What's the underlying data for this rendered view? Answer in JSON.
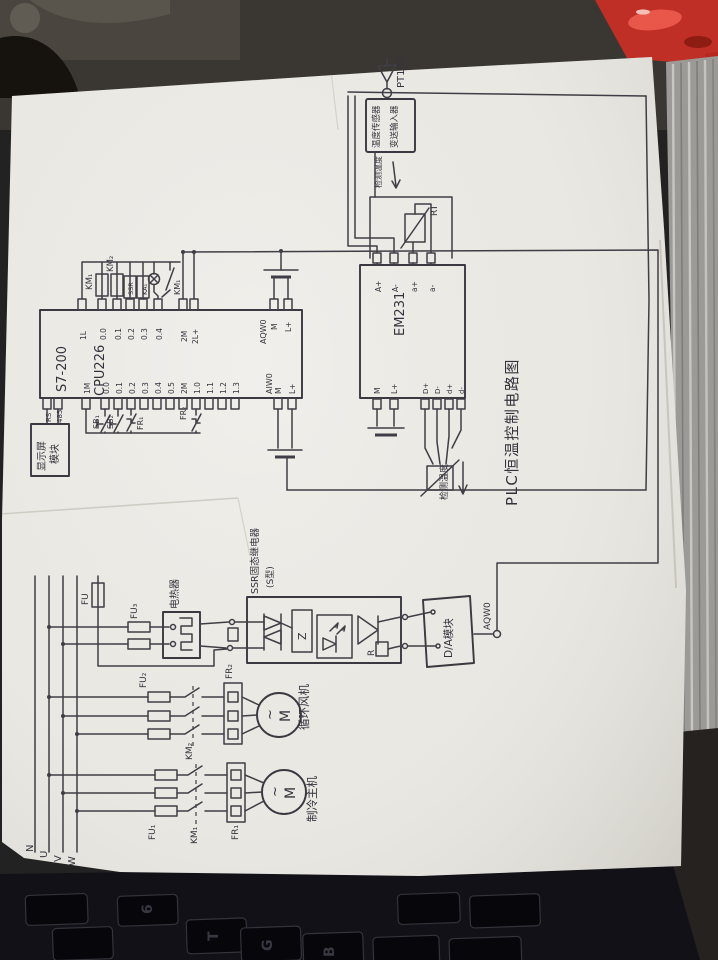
{
  "title": "PLC恒温控制电路图",
  "sensor": {
    "probe": "PT100",
    "transmitter_col1": "温度传感器",
    "transmitter_col2": "变送输入器",
    "measure": "检测温度"
  },
  "analog_loop": {
    "rt": "RT",
    "em_measure": "检测温度"
  },
  "plc": {
    "model_line1": "S7-200",
    "model_line2": "CPU226",
    "out_terms": [
      "1L",
      "0.0",
      "0.1",
      "0.2",
      "0.3",
      "0.4",
      "2M",
      "2L+"
    ],
    "aqw_label": "AQW0",
    "aqw_terms": [
      "M",
      "L+"
    ],
    "in_terms": [
      "1M",
      "0.0",
      "0.1",
      "0.2",
      "0.3",
      "0.4",
      "0.5",
      "2M",
      "1.0",
      "1.1",
      "1.2",
      "1.3"
    ],
    "aiw_label": "AIW0",
    "aiw_terms": [
      "M",
      "L+"
    ],
    "comm_terms": [
      "RS",
      "485"
    ]
  },
  "coils": {
    "km1": "KM₁",
    "km2": "KM₂",
    "ssr": "SSR",
    "ka": "KA₁",
    "km1_contact": "KM₁"
  },
  "inputs": {
    "sb1": "SB₁",
    "sb2": "SB₂",
    "fr1": "FR₁",
    "fr2": "FR₂"
  },
  "display_module": {
    "col1": "显示屏",
    "col2": "模块"
  },
  "em231": {
    "name": "EM231",
    "top_terms": [
      "A+",
      "A-",
      "a+",
      "a-"
    ],
    "bl_terms": [
      "M",
      "L+"
    ],
    "br_terms": [
      "D+",
      "D-",
      "d+",
      "d-"
    ]
  },
  "power": {
    "phases": [
      "N",
      "U",
      "V",
      "W"
    ],
    "fu": "FU",
    "fu3": "FU₃",
    "heater": "电热器",
    "ssr_title1": "SSR固态继电器",
    "ssr_title2": "(S型)",
    "z": "Z",
    "r": "R",
    "da": "D/A模块",
    "aqw": "AQW0",
    "fan": {
      "fu": "FU₂",
      "km": "KM₂",
      "fr": "FR₂",
      "m": "M",
      "tilde": "~",
      "name": "循环风机"
    },
    "chiller": {
      "fu": "FU₁",
      "km": "KM₁",
      "fr": "FR₁",
      "m": "M",
      "tilde": "~",
      "name": "制冷主机"
    }
  },
  "scene": {
    "keyboard_keys": [
      "6",
      "T",
      "G",
      "B"
    ]
  }
}
